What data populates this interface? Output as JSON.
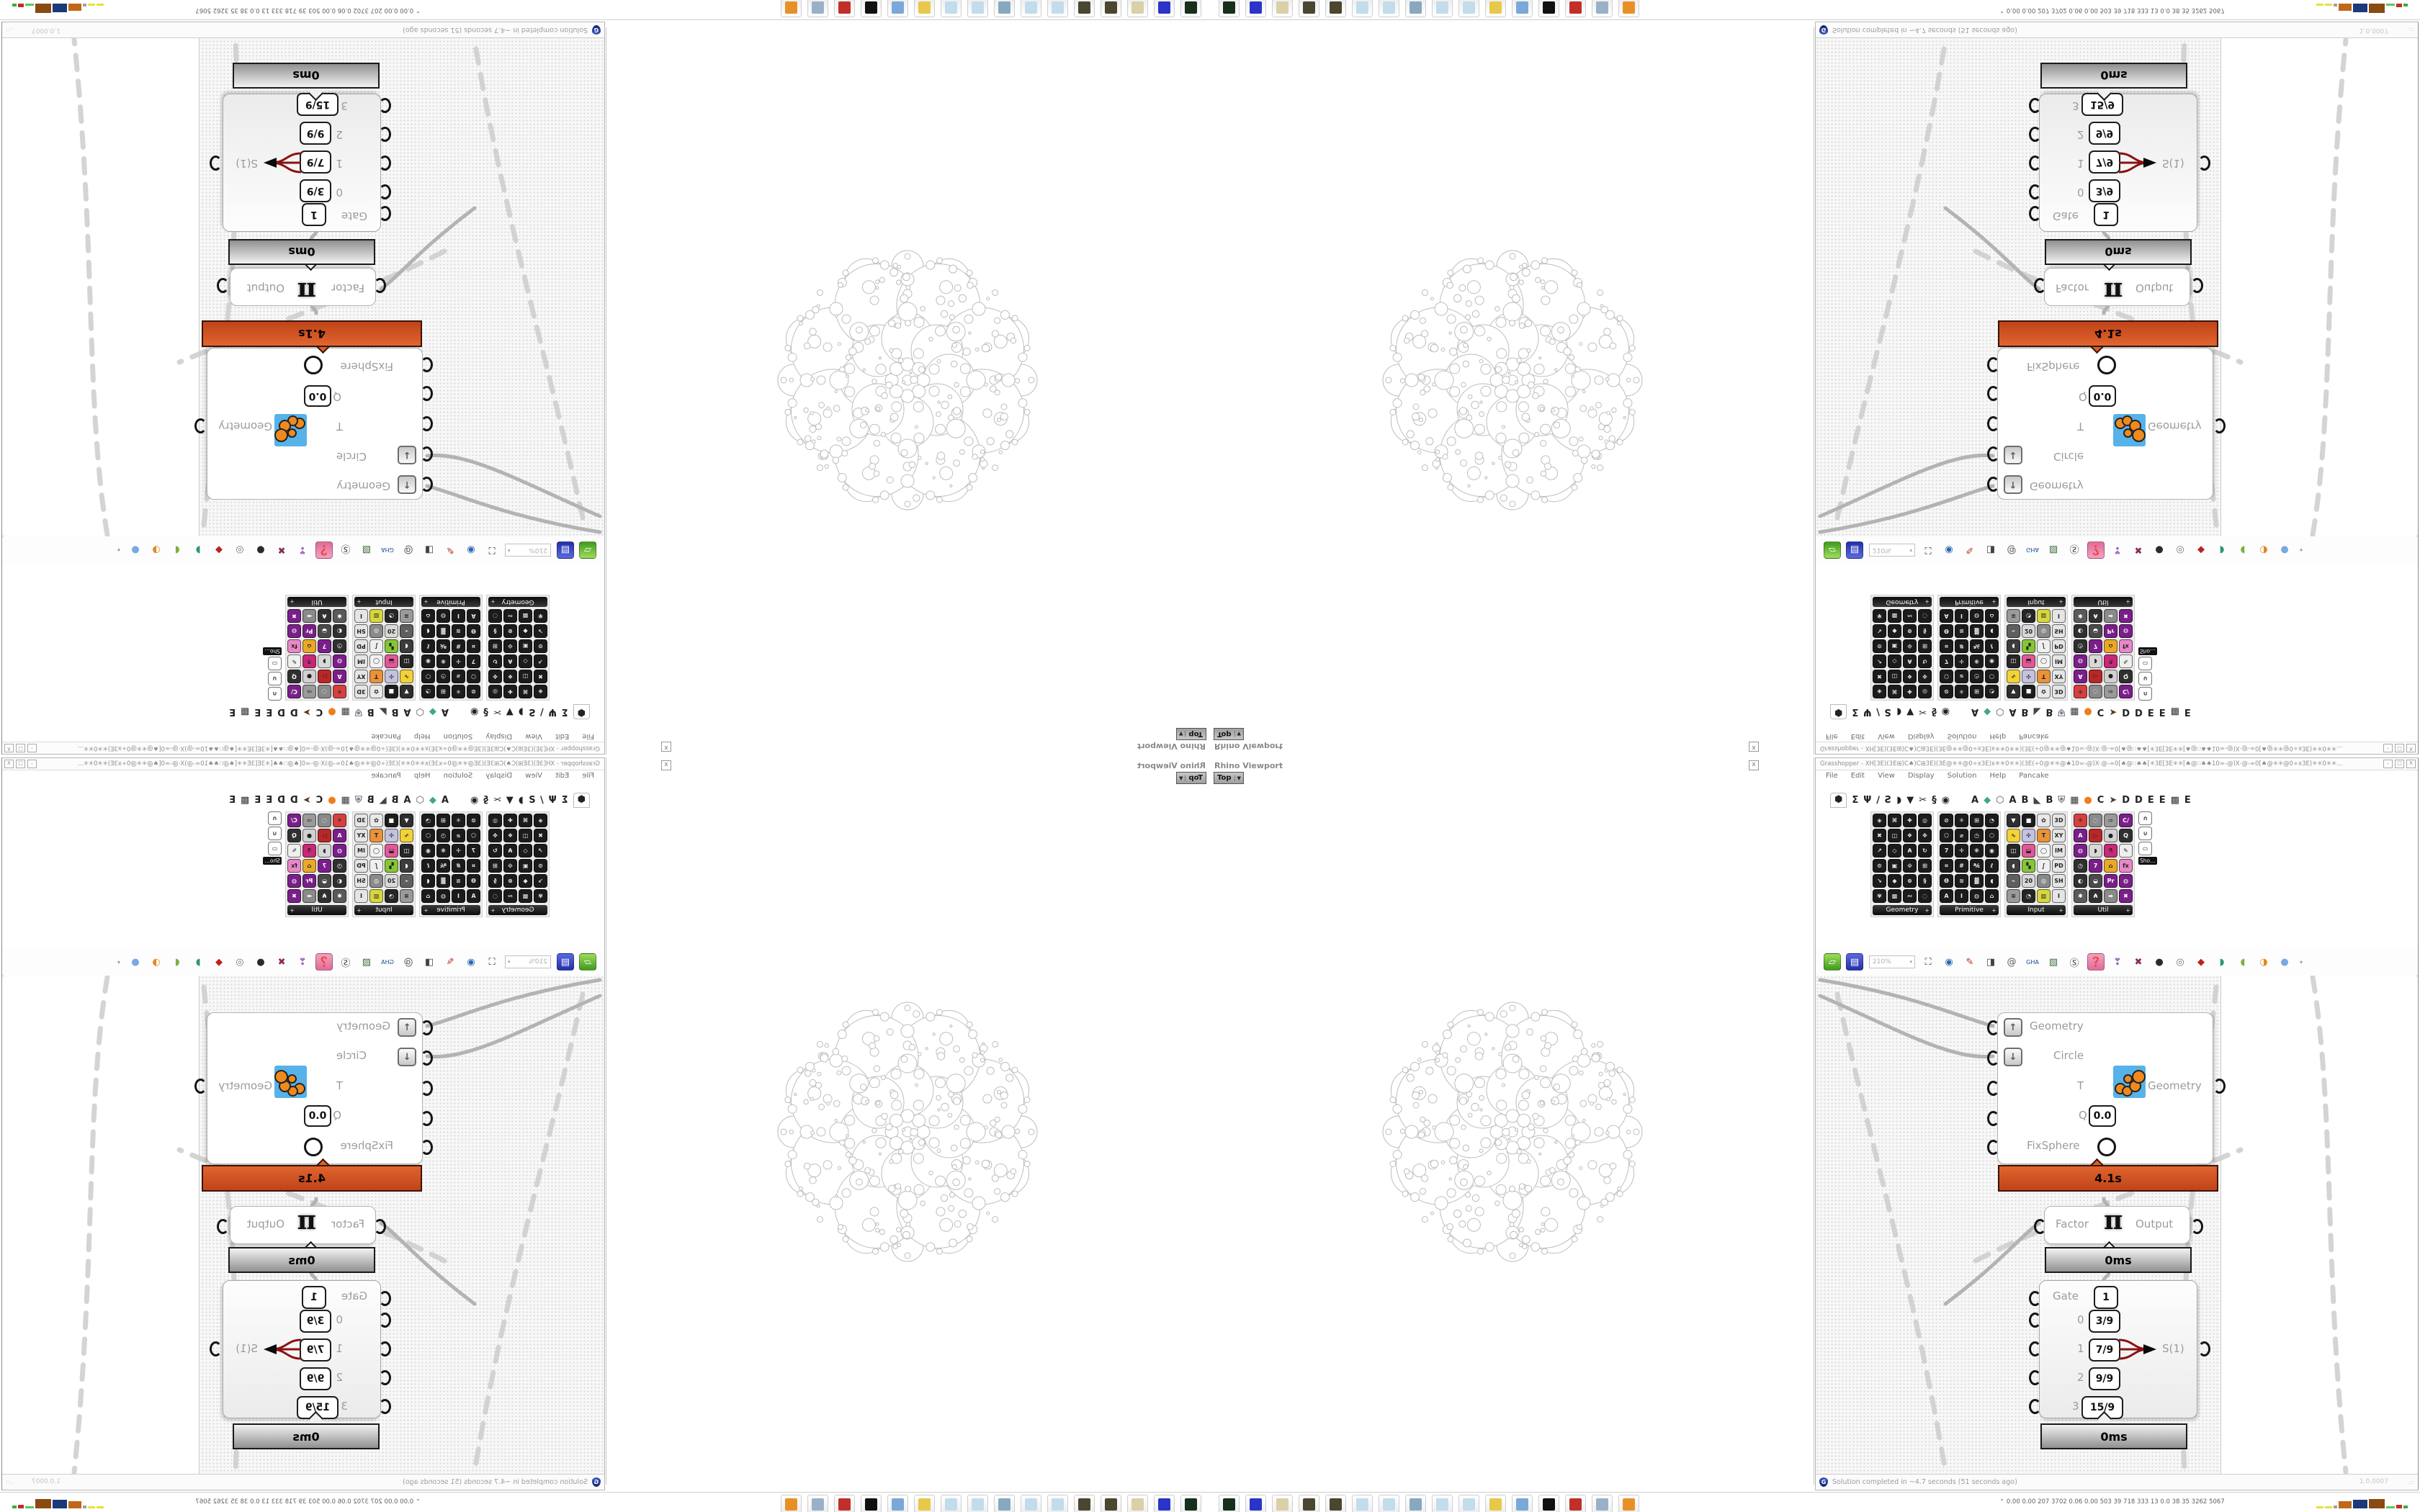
{
  "rhino": {
    "title": "Rhino Viewport",
    "viewport_label": "Top",
    "viewport_dropdown": "▼",
    "close_label": "x"
  },
  "gh": {
    "title": "Grasshopper - XH[3E)(3E⊞)C♠)C⊞3E)(3E@✳✳@0÷x3E)x✳✳0✳✳)(3E(÷0@✳✳@♠10∞-@)X·@-∞0[♠@∷♠♠[✳3E[3E✳✳[♠@∷♠♠10∞-@)X·@-∞0[♠@✳✳@0÷x3E)✳✳0✳✳...",
    "window_buttons": [
      "–",
      "□",
      "X"
    ],
    "menu": [
      "File",
      "Edit",
      "View",
      "Display",
      "Solution",
      "Help",
      "Pancake"
    ],
    "status_text": "Solution completed in ~4.7 seconds (51 seconds ago)",
    "status_version": "1.0.0007",
    "grip": ".::"
  },
  "tabs": {
    "left": [
      {
        "g": "⬢",
        "c": "#222",
        "box": true
      },
      {
        "g": "Σ",
        "c": "#222"
      },
      {
        "g": "Ψ",
        "c": "#222"
      },
      {
        "g": "∕",
        "c": "#222"
      },
      {
        "g": "Ƨ",
        "c": "#222"
      },
      {
        "g": "◗",
        "c": "#222"
      },
      {
        "g": "▼",
        "c": "#222"
      },
      {
        "g": "✂",
        "c": "#222"
      },
      {
        "g": "§",
        "c": "#222"
      },
      {
        "g": "◉",
        "c": "#222"
      }
    ],
    "right": [
      {
        "g": "A",
        "c": "#222"
      },
      {
        "g": "◆",
        "c": "#3fa88a"
      },
      {
        "g": "⬡",
        "c": "#555"
      },
      {
        "g": "A",
        "c": "#222"
      },
      {
        "g": "B",
        "c": "#222"
      },
      {
        "g": "◣",
        "c": "#444"
      },
      {
        "g": "B",
        "c": "#222"
      },
      {
        "g": "⛨",
        "c": "#778"
      },
      {
        "g": "▦",
        "c": "#333"
      },
      {
        "g": "●",
        "c": "#f07c1c"
      },
      {
        "g": "C",
        "c": "#222"
      },
      {
        "g": "➤",
        "c": "#5a3a22"
      },
      {
        "g": "D",
        "c": "#222"
      },
      {
        "g": "D",
        "c": "#222"
      },
      {
        "g": "E",
        "c": "#222"
      },
      {
        "g": "E",
        "c": "#222"
      },
      {
        "g": "▩",
        "c": "#333"
      },
      {
        "g": "E",
        "c": "#222"
      }
    ]
  },
  "ribbon": {
    "groups": [
      {
        "name": "Geometry",
        "style": "hex",
        "icons": [
          "◈",
          "⌘",
          "✚",
          "◎",
          "✖",
          "◫",
          "❖",
          "✥",
          "↗",
          "◇",
          "₳",
          "↻",
          "⊙",
          "▣",
          "⟐",
          "⊞",
          "↘",
          "◆",
          "⊗",
          "§",
          "✾",
          "▩",
          "∾",
          "◌"
        ]
      },
      {
        "name": "Primitive",
        "style": "hex",
        "icons": [
          "⊘",
          "✳",
          "⊞",
          "◔",
          "⬠",
          "⌀",
          "◷",
          "⬡",
          "7",
          "✛",
          "❋",
          "◉",
          "⌗",
          "#",
          "℀",
          "ℓ",
          "Ѳ",
          "≋",
          "▓",
          "◖",
          "A",
          "Ⅰ",
          "◍",
          "⌂"
        ]
      },
      {
        "name": "Input",
        "style": "color",
        "icons": [
          "▼|#2e2e2e",
          "■|#1c1c1c",
          "✿|#e8e8e8",
          "3D|#e5e5e5",
          "∿|#f2d23a",
          "✣|#c3c3e0",
          "T|#e8923a",
          "XY|#e5e5e5",
          "◫|#262626",
          "⬓|#e05898",
          "◯|#f3f3f3",
          "IM|#e5e5e5",
          "◖|#3c3c3c",
          "▚|#86c636",
          "∫|#f0f0f0",
          "PD|#e5e5e5",
          "⌁|#5f5f5f",
          "20|#d8d8d8",
          "◎|#8a8a8a",
          "SH|#e5e5e5",
          "≡|#9a9a9a",
          "◔|#262626",
          "▥|#d6d640",
          "Ⅰ|#e5e5e5"
        ]
      },
      {
        "name": "Util",
        "style": "color",
        "icons": [
          "⚘|#d44040",
          "◌|#8a8a8a",
          "⇨|#9a9a9a",
          "C/|#7a1f8a",
          "A|#7a1f8a",
          "▷|#b82828",
          "●|#d0d0d0",
          "Q|#303030",
          "◍|#7a1f8a",
          "◗|#d8d8d8",
          "⚗|#c82878",
          "✎|#efefef",
          "◷|#303030",
          "7|#7a1f8a",
          "⌂|#e8a828",
          "fx|#e888c8",
          "◐|#303030",
          "◒|#4a4a4a",
          "Pr|#7a1f8a",
          "◍|#7a1f8a",
          "✱|#5a5a5a",
          "₳|#303030",
          "➡|#8a8a8a",
          "✖|#7a1f8a"
        ]
      }
    ],
    "mini": {
      "label": "Sho…",
      "icons": [
        "∩",
        "∪",
        "▭"
      ]
    }
  },
  "toolbar": {
    "zoom_value": "210%",
    "items": [
      {
        "n": "open-file",
        "g": "▱",
        "bg": "linear-gradient(#9fdc5a,#3f9a1f)",
        "fg": "#fff"
      },
      {
        "n": "save-file",
        "g": "▤",
        "bg": "linear-gradient(#5a6ae0,#2330a8)",
        "fg": "#fff"
      },
      {
        "n": "zoom-extents",
        "g": "⛶",
        "bg": "none",
        "fg": "#333"
      },
      {
        "n": "preview-eye",
        "g": "◉",
        "bg": "none",
        "fg": "#2a6ab0"
      },
      {
        "n": "sketch-pen",
        "g": "✎",
        "bg": "none",
        "fg": "#b03020"
      },
      {
        "n": "box-widget",
        "g": "◨",
        "bg": "none",
        "fg": "#444"
      },
      {
        "n": "doc-at",
        "g": "@",
        "bg": "none",
        "fg": "#555"
      },
      {
        "n": "gha-loader",
        "g": "GHA",
        "bg": "none",
        "fg": "#1a4a9a"
      },
      {
        "n": "map-search",
        "g": "▧",
        "bg": "none",
        "fg": "#3a6a3a"
      },
      {
        "n": "s-magnifier",
        "g": "Ⓢ",
        "bg": "none",
        "fg": "#333"
      },
      {
        "n": "pink-box",
        "g": "❓",
        "bg": "linear-gradient(#f4a2c0,#e06a98)",
        "fg": "#fff"
      },
      {
        "n": "balloon",
        "g": "❣",
        "bg": "none",
        "fg": "#a070c0"
      },
      {
        "n": "disable-cross",
        "g": "✖",
        "bg": "none",
        "fg": "#8a2a5a"
      },
      {
        "n": "preview-dark",
        "g": "●",
        "bg": "none",
        "fg": "#2a2a2a"
      },
      {
        "n": "preview-wire",
        "g": "◎",
        "bg": "none",
        "fg": "#777"
      },
      {
        "n": "gem-red",
        "g": "◆",
        "bg": "none",
        "fg": "#c02020"
      },
      {
        "n": "gem-green",
        "g": "◗",
        "bg": "none",
        "fg": "#2a9a6a"
      },
      {
        "n": "gem-leaf",
        "g": "◖",
        "bg": "none",
        "fg": "#7ab040"
      },
      {
        "n": "gem-orange",
        "g": "◑",
        "bg": "none",
        "fg": "#e08a20"
      },
      {
        "n": "gem-blue",
        "g": "●",
        "bg": "none",
        "fg": "#7aa8e0"
      }
    ],
    "more_arrow": "▾"
  },
  "components": {
    "fixsphere": {
      "row_geometry": "Geometry",
      "row_circle": "Circle",
      "row_t": "T",
      "row_q": "Q",
      "q_value": "0.0",
      "row_fix": "FixSphere",
      "up": "↑",
      "down": "↓",
      "output": "Geometry",
      "time": "4.1s"
    },
    "factor": {
      "left": "Factor",
      "symbol": "π",
      "right": "Output",
      "time": "0ms"
    },
    "gate": {
      "label": "Gate",
      "gate_value": "1",
      "r0i": "0",
      "r0v": "3/9",
      "r1i": "1",
      "r1v": "7/9",
      "r2i": "2",
      "r2v": "9/9",
      "r3i": "3",
      "r3v": "15/9",
      "output": "S(1)",
      "time": "0ms"
    }
  },
  "taskbar": {
    "stats_caret": "⌃",
    "stats": "0.00 0.00  207  3702 0.06 0.00  503   39   718  333   13   0.0   38   35  3262 5067",
    "icons": [
      {
        "n": "terminal",
        "c": "#16301c"
      },
      {
        "n": "floppy-64",
        "c": "#2a35c8"
      },
      {
        "n": "script-scroll",
        "c": "#d9d0a8"
      },
      {
        "n": "coin-1",
        "c": "#4a4630"
      },
      {
        "n": "coin-2",
        "c": "#4a4630"
      },
      {
        "n": "notepad-1",
        "c": "#c2dcec"
      },
      {
        "n": "notepad-2",
        "c": "#c2dcec"
      },
      {
        "n": "monitor",
        "c": "#88a8c0"
      },
      {
        "n": "notepad-3",
        "c": "#c2dcec"
      },
      {
        "n": "notepad-4",
        "c": "#c2dcec"
      },
      {
        "n": "folder-yellow",
        "c": "#e8c84a"
      },
      {
        "n": "computer-blue",
        "c": "#7aa8d8"
      },
      {
        "n": "arrows-bw",
        "c": "#101010"
      },
      {
        "n": "red-badge",
        "c": "#c03028"
      },
      {
        "n": "calculator",
        "c": "#9ab0c8"
      },
      {
        "n": "browser-orange",
        "c": "#e89028"
      }
    ],
    "bars": [
      {
        "c": "#e8e13a",
        "w": 10,
        "h": 3
      },
      {
        "c": "#e8e13a",
        "w": 10,
        "h": 3
      },
      {
        "c": "#a0a0a0",
        "w": 5,
        "h": 4
      },
      {
        "c": "#c06818",
        "w": 18,
        "h": 10
      },
      {
        "c": "#1a3a7a",
        "w": 20,
        "h": 12
      },
      {
        "c": "#8a4a10",
        "w": 22,
        "h": 13
      },
      {
        "c": "#58c858",
        "w": 12,
        "h": 3
      },
      {
        "c": "#c03028",
        "w": 8,
        "h": 5
      },
      {
        "c": "#40a840",
        "w": 6,
        "h": 4
      }
    ]
  }
}
